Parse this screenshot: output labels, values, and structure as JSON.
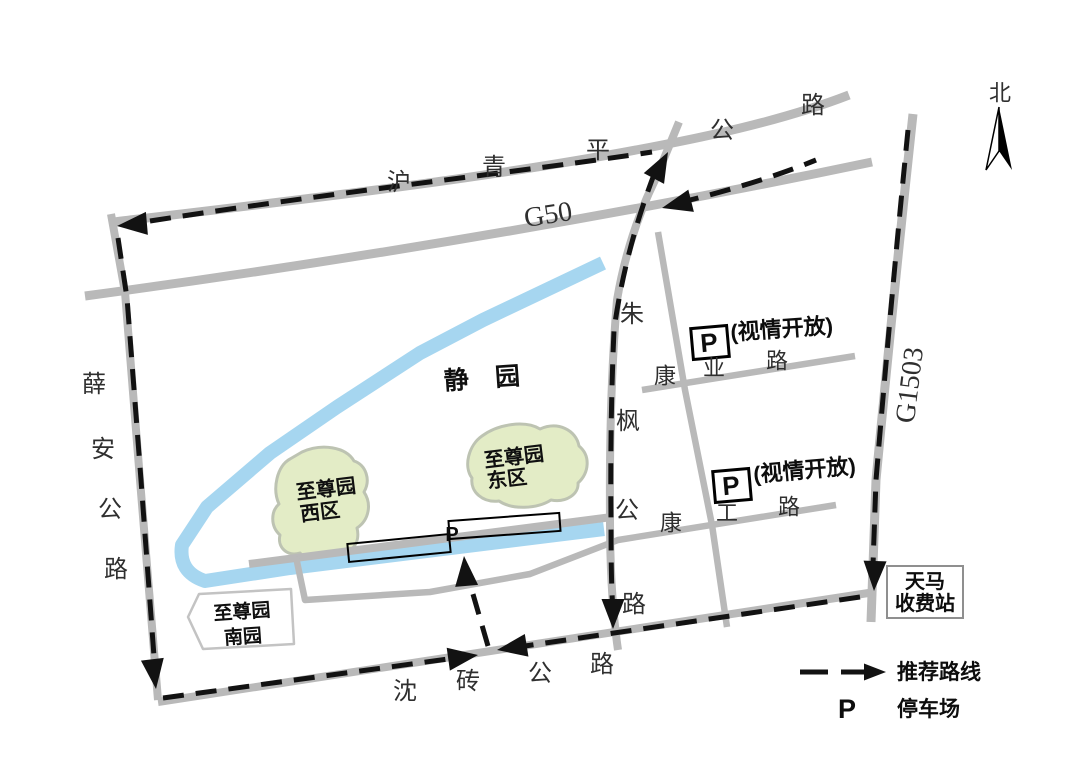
{
  "map": {
    "colors": {
      "road": "#b9b9b9",
      "river": "#a6d6f0",
      "green_area": "#e3ecc6",
      "green_border": "#bdc3b2",
      "route": "#121212",
      "box_border": "#000000",
      "toll_border": "#8f8f8f",
      "south_garden_border": "#c3c3c3"
    },
    "roads": [
      {
        "name": "huqingping-highway-road",
        "d": "M113,222 C300,200 500,177 662,145 C735,131 800,114 849,95",
        "w": 9
      },
      {
        "name": "g50-highway-road",
        "d": "M85,296 Q500,240 872,162",
        "w": 9
      },
      {
        "name": "xuean-highway-road",
        "d": "M111,214 L125,292 L140,480 L158,700",
        "w": 8
      },
      {
        "name": "shenzhuan-highway-road",
        "d": "M158,702 L875,592",
        "w": 8
      },
      {
        "name": "g1503-highway-road",
        "d": "M913,114 Q893,300 876,480 L871,622",
        "w": 9
      },
      {
        "name": "zhufeng-highway-road",
        "d": "M679,122 L656,178 Q628,235 617,300 Q609,395 610,520 Q610,595 618,650",
        "w": 8
      },
      {
        "name": "park-front-road",
        "d": "M249,564 L612,517",
        "w": 8
      },
      {
        "name": "service-kanggong-road",
        "d": "M296,557 L305,600 L430,592 L530,574 L618,540 L836,505",
        "w": 6.5
      },
      {
        "name": "kangye-road",
        "d": "M642,390 L855,356",
        "w": 6.5
      },
      {
        "name": "side-connector-road",
        "d": "M658,232 L685,390 L712,525 L727,627",
        "w": 6.5
      }
    ],
    "river": {
      "name": "river",
      "d": "M603,263 L483,320 L420,353 L337,407 L270,453 L207,507 L182,545 Q178,572 205,581 L290,568 L604,529",
      "w": 14
    },
    "green_areas": [
      {
        "name": "zhizunyuan-west-area",
        "d": "M302,452 C322,443 346,447 354,461 C366,465 371,480 364,492 C372,504 369,520 357,528 C361,544 350,556 335,553 C327,563 309,564 300,553 C287,557 277,547 280,535 C270,526 271,511 279,504 C272,489 277,466 290,459 Z"
      },
      {
        "name": "zhizunyuan-east-area",
        "d": "M482,436 C498,424 525,420 540,429 C558,421 576,430 579,446 C591,456 589,473 578,483 C579,494 566,503 551,500 C537,509 512,510 499,501 C483,503 470,492 472,478 C463,466 469,445 482,436 Z"
      }
    ],
    "south_garden": {
      "points": "188,617 199,594 291,589 294,644 203,649",
      "line1": "至尊园",
      "line2": "南园",
      "l1x": 242,
      "l1y": 612,
      "l2x": 243,
      "l2y": 637
    },
    "parking_strips": [
      {
        "x": 348,
        "y": 539,
        "w": 102,
        "h": 18,
        "rot": -5.6,
        "cx": 399,
        "cy": 548
      },
      {
        "x": 449,
        "y": 517,
        "w": 111,
        "h": 18,
        "rot": -4.2,
        "cx": 504,
        "cy": 526
      }
    ],
    "strip_p": {
      "t": "P",
      "x": 452,
      "y": 541
    },
    "routes": [
      {
        "name": "route-huqingping",
        "d": "M150,221 C350,190 520,172 652,152"
      },
      {
        "name": "route-g50-east",
        "d": "M678,203 Q760,183 816,160"
      },
      {
        "name": "route-zhufeng",
        "d": "M655,172 Q625,250 614,330 Q610,420 611,520 Q611,590 613,608"
      },
      {
        "name": "route-xuean",
        "d": "M118,238 L127,298 L141,480 L155,670"
      },
      {
        "name": "route-shenzhuan-west",
        "d": "M163,698 L448,659"
      },
      {
        "name": "route-shenzhuan-east",
        "d": "M860,597 L525,646"
      },
      {
        "name": "route-g1503",
        "d": "M908,130 Q891,300 876,480 L873,565"
      },
      {
        "name": "route-parking-access",
        "d": "M488,646 L466,570"
      }
    ],
    "arrows": [
      {
        "name": "arrow-huqingping-west",
        "x": 117,
        "y": 226,
        "a": 175
      },
      {
        "name": "arrow-zhufeng-north",
        "x": 668,
        "y": 152,
        "a": -62
      },
      {
        "name": "arrow-g50-west",
        "x": 662,
        "y": 208,
        "a": 166
      },
      {
        "name": "arrow-xuean-south",
        "x": 156,
        "y": 689,
        "a": 83
      },
      {
        "name": "arrow-shenzhuan-eastbound",
        "x": 478,
        "y": 655,
        "a": -8
      },
      {
        "name": "arrow-shenzhuan-westbound",
        "x": 497,
        "y": 650,
        "a": 171
      },
      {
        "name": "arrow-g1503-south",
        "x": 874,
        "y": 591,
        "a": 92
      },
      {
        "name": "arrow-zhufeng-south",
        "x": 613,
        "y": 629,
        "a": 90
      },
      {
        "name": "arrow-parking-access",
        "x": 464,
        "y": 556,
        "a": -95
      }
    ],
    "p_boxes": [
      {
        "name": "parking-box-kangye",
        "bx": 692,
        "by": 327,
        "bw": 36,
        "bh": 31,
        "rot": -5,
        "p": "P",
        "note": "(视情开放)",
        "nx": 731,
        "ny": 340,
        "nr": -4
      },
      {
        "name": "parking-box-kanggong",
        "bx": 714,
        "by": 470,
        "bw": 36,
        "bh": 31,
        "rot": -5,
        "p": "P",
        "note": "(视情开放)",
        "nx": 754,
        "ny": 482,
        "nr": -5
      }
    ],
    "toll": {
      "x": 887,
      "y": 566,
      "w": 76,
      "h": 52,
      "line1": "天马",
      "line2": "收费站"
    },
    "compass": {
      "label": "北",
      "lx": 1000,
      "ly": 93,
      "tip": [
        999,
        107
      ],
      "left": [
        986,
        170
      ],
      "right": [
        1012,
        170
      ],
      "notch": [
        999,
        151
      ]
    },
    "legend": {
      "y": 672,
      "dash_x1": 800,
      "dash_x2": 828,
      "line_x1": 841,
      "line_x2": 866,
      "tip_x": 886,
      "route_label": "推荐路线",
      "route_x": 897,
      "route_y": 679,
      "p": "P",
      "p_x": 847,
      "p_y": 718,
      "parking_label": "停车场",
      "parking_x": 897,
      "parking_y": 716
    },
    "labels": [
      {
        "t": "沪",
        "x": 399,
        "y": 182,
        "s": 24,
        "cls": "road-name"
      },
      {
        "t": "青",
        "x": 494,
        "y": 167,
        "s": 24,
        "cls": "road-name"
      },
      {
        "t": "平",
        "x": 598,
        "y": 150,
        "s": 24,
        "cls": "road-name"
      },
      {
        "t": "公",
        "x": 722,
        "y": 130,
        "s": 24,
        "cls": "road-name"
      },
      {
        "t": "路",
        "x": 813,
        "y": 105,
        "s": 24,
        "cls": "road-name"
      },
      {
        "t": "G50",
        "x": 548,
        "y": 214,
        "s": 28,
        "r": -9,
        "cls": "hwy-name"
      },
      {
        "t": "G1503",
        "x": 909,
        "y": 385,
        "s": 28,
        "r": -83,
        "cls": "hwy-name"
      },
      {
        "t": "薛",
        "x": 94,
        "y": 384,
        "s": 24,
        "cls": "road-name"
      },
      {
        "t": "安",
        "x": 103,
        "y": 449,
        "s": 24,
        "cls": "road-name"
      },
      {
        "t": "公",
        "x": 110,
        "y": 509,
        "s": 24,
        "cls": "road-name"
      },
      {
        "t": "路",
        "x": 116,
        "y": 569,
        "s": 24,
        "cls": "road-name"
      },
      {
        "t": "朱",
        "x": 632,
        "y": 314,
        "s": 24,
        "cls": "road-name"
      },
      {
        "t": "枫",
        "x": 628,
        "y": 421,
        "s": 24,
        "cls": "road-name"
      },
      {
        "t": "公",
        "x": 627,
        "y": 510,
        "s": 24,
        "cls": "road-name"
      },
      {
        "t": "路",
        "x": 634,
        "y": 604,
        "s": 24,
        "cls": "road-name"
      },
      {
        "t": "康",
        "x": 665,
        "y": 376,
        "s": 22,
        "cls": "road-name"
      },
      {
        "t": "业",
        "x": 714,
        "y": 368,
        "s": 22,
        "cls": "road-name"
      },
      {
        "t": "路",
        "x": 777,
        "y": 361,
        "s": 22,
        "cls": "road-name"
      },
      {
        "t": "康",
        "x": 671,
        "y": 523,
        "s": 22,
        "cls": "road-name"
      },
      {
        "t": "工",
        "x": 727,
        "y": 513,
        "s": 22,
        "cls": "road-name"
      },
      {
        "t": "路",
        "x": 789,
        "y": 507,
        "s": 22,
        "cls": "road-name"
      },
      {
        "t": "沈",
        "x": 405,
        "y": 691,
        "s": 24,
        "cls": "road-name"
      },
      {
        "t": "砖",
        "x": 468,
        "y": 681,
        "s": 24,
        "cls": "road-name"
      },
      {
        "t": "公",
        "x": 540,
        "y": 673,
        "s": 24,
        "cls": "road-name"
      },
      {
        "t": "路",
        "x": 602,
        "y": 664,
        "s": 24,
        "cls": "road-name"
      },
      {
        "t": "北",
        "x": 1000,
        "y": 93,
        "s": 22,
        "cls": "road-name"
      },
      {
        "t": "静 园",
        "x": 487,
        "y": 378,
        "s": 25,
        "r": -4,
        "ls": 10,
        "cls": "park-name"
      },
      {
        "t": "至尊园",
        "x": 514,
        "y": 457,
        "s": 20,
        "r": -7,
        "cls": "park-name"
      },
      {
        "t": "东区",
        "x": 507,
        "y": 479,
        "s": 20,
        "r": -7,
        "cls": "park-name"
      },
      {
        "t": "至尊园",
        "x": 326,
        "y": 489,
        "s": 20,
        "r": -7,
        "cls": "park-name"
      },
      {
        "t": "西区",
        "x": 320,
        "y": 512,
        "s": 20,
        "r": -7,
        "cls": "park-name"
      }
    ]
  }
}
